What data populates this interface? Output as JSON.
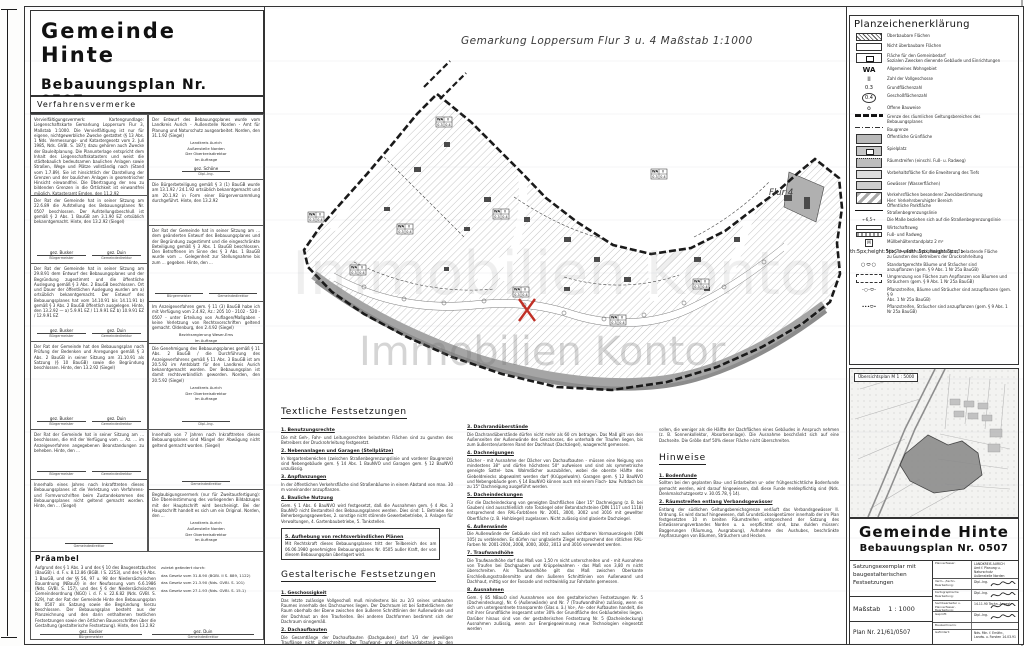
{
  "header": {
    "municipality": "Gemeinde  Hinte",
    "plan_title": "Bebauungsplan  Nr. 0507"
  },
  "map": {
    "title": "Gemarkung  Loppersum    Flur 3 u. 4     Maßstab 1:1000",
    "flur_label": "Flur 4",
    "watermark": "Immobilien Kontor",
    "wa_box": {
      "use": "WA",
      "storeys": "II",
      "grz": "0.3",
      "gfz": "0.4"
    }
  },
  "verfahrensvermerke": {
    "header": "Verfahrensvermerke",
    "left": [
      {
        "text": "Vervielfältigungsvermerk: Kartengrundlage: Liegenschaftskarte Gemarkung Loppersum Flur 3, Maßstab 1:1000. Die Vervielfältigung ist nur für eigene, nichtgewerbliche Zwecke gestattet (§ 13 Abs. 1 Nds. Vermessungs- und Katastergesetz vom 2. Juli 1985, Nds. GVBl. S. 187); dazu gehören auch Zwecke der Bauleitplanung. Die Planunterlage entspricht dem Inhalt des Liegenschaftskatasters und weist die städtebaulich bedeutsamen baulichen Anlagen sowie Straßen, Wege und Plätze vollständig nach (Stand vom 1.7.89). Sie ist hinsichtlich der Darstellung der Grenzen und der baulichen Anlagen in geometrischer Hinsicht einwandfrei. Die Übertragung der neu zu bildenden Grenzen in die Örtlichkeit ist einwandfrei möglich. Katasteramt Emden, den 11.2.92",
        "sigs": [
          {
            "name": "gez. Specht",
            "role": "Oberamtsrat"
          }
        ]
      },
      {
        "text": "Der Rat der Gemeinde hat in seiner Sitzung am 22.6.89 die Aufstellung des Bebauungsplanes Nr. 0507 beschlossen. Der Aufstellungsbeschluß ist gemäß § 2 Abs. 1 BauGB am 3.1.90 EZ ortsüblich bekanntgemacht. Hinte, den 13.2.92 (Siegel)",
        "sigs": [
          {
            "name": "gez. Busker",
            "role": "Bürgermeister"
          },
          {
            "name": "gez. Duin",
            "role": "Gemeindedirektor"
          }
        ]
      },
      {
        "text": "Der Rat der Gemeinde hat in seiner Sitzung am 29.8.91 dem Entwurf des Bebauungsplanes und der Begründung zugestimmt und die öffentliche Auslegung gemäß § 3 Abs. 2 BauGB beschlossen. Ort und Dauer der öffentlichen Auslegung wurden am a) ortsüblich bekanntgemacht. Der Entwurf des Bebauungsplanes hat vom 14.10.91 bis 14.11.91 b) gemäß § 3 Abs. 2 BauGB öffentlich ausgelegen. Hinte, den 13.2.92  —  a) 5.9.91 EZ / 11.9.91 EZ   b) 10.9.91 EZ / 12.9.91 EZ",
        "sigs": [
          {
            "name": "gez. Busker",
            "role": "Bürgermeister"
          },
          {
            "name": "gez. Duin",
            "role": "Gemeindedirektor"
          }
        ]
      },
      {
        "text": "Der Rat der Gemeinde hat den Bebauungsplan nach Prüfung der Bedenken und Anregungen gemäß § 3 Abs. 2 BauGB in seiner Sitzung am 31.10.91 als Satzung (§ 10 BauGB) sowie die Begründung beschlossen. Hinte, den 13.2.92 (Siegel)",
        "sigs": [
          {
            "name": "gez. Busker",
            "role": "Bürgermeister"
          },
          {
            "name": "gez. Duin",
            "role": "Gemeindedirektor"
          }
        ]
      },
      {
        "text": "Der Rat der Gemeinde hat in seiner Sitzung am ... beschlossen, die mit der Verfügung vom ... Az. ... im Anzeigeverfahren angegebenen Beanstandungen zu beheben. Hinte, den ...",
        "sigs": [
          {
            "name": "",
            "role": "Bürgermeister"
          },
          {
            "name": "",
            "role": "Gemeindedirektor"
          }
        ]
      },
      {
        "text": "Innerhalb eines Jahres nach Inkrafttreten dieses Bebauungsplanes ist die Verletzung von Verfahrens- und Formvorschriften beim Zustandekommen des Bebauungsplanes nicht geltend gemacht worden. Hinte, den ... (Siegel)",
        "sigs": [
          {
            "name": "",
            "role": "Gemeindedirektor"
          }
        ]
      }
    ],
    "right": [
      {
        "text": "Der Entwurf des Bebauungsplanes wurde vom Landkreis Aurich - Außenstelle Norden - Amt für Planung und Naturschutz ausgearbeitet. Norden, den 31.1.92 (Siegel)",
        "center": [
          "Landkreis Aurich",
          "Außenstelle Norden",
          "Der Oberkreisdirektor",
          "Im Auftrage"
        ],
        "sigs": [
          {
            "name": "gez. Schöne",
            "role": "Dipl.-Ing."
          }
        ]
      },
      {
        "text": "Die Bürgerbeteiligung gemäß § 3 (1) BauGB wurde am 13.1.92 / 24.1.92 ortsüblich bekanntgemacht und am 20.1.92 in Form einer Bürgerversammlung durchgeführt. Hinte, den 13.2.92"
      },
      {
        "text": "Der Rat der Gemeinde hat in seiner Sitzung am ... dem geänderten Entwurf des Bebauungsplanes und der Begründung zugestimmt und die eingeschränkte Beteiligung gemäß § 3 Abs. 1 BauGB beschlossen. Den Betroffenen im Sinne des § 3 Abs. 1 BauGB wurde vom ... Gelegenheit zur Stellungnahme bis zum ... gegeben. Hinte, den ...",
        "sigs": [
          {
            "name": "",
            "role": "Bürgermeister"
          },
          {
            "name": "",
            "role": "Gemeindedirektor"
          }
        ]
      },
      {
        "text": "Im Anzeigeverfahren gem. § 11 (3) BauGB habe ich mit Verfügung vom 2.4.92, Az.: 205 10 - 2102 - 520 - 0507 - unter Erteilung von Auflagen/Maßgaben - keine Verletzung von Rechtsvorschriften geltend gemacht. Oldenburg, den 2.4.92 (Siegel)",
        "center": [
          "Bezirksregierung Weser-Ems",
          "Im Auftrage"
        ],
        "sigs": [
          {
            "name": "gez. Dr. Müller",
            "role": ""
          }
        ]
      },
      {
        "text": "Die Genehmigung des Bebauungsplanes gemäß § 11 Abs. 2 BauGB / die Durchführung des Anzeigeverfahrens gemäß § 11 Abs. 3 BauGB ist am 20.5.92 im Amtsblatt für den Landkreis Aurich bekanntgemacht worden. Der Bebauungsplan ist damit rechtsverbindlich geworden. Norden, den 20.5.92 (Siegel)",
        "center": [
          "Landkreis Aurich",
          "Der Oberkreisdirektor",
          "Im Auftrage"
        ],
        "sigs": [
          {
            "name": "",
            "role": "Dipl.-Ing."
          }
        ]
      },
      {
        "text": "Innerhalb von 7 Jahren nach Inkrafttreten dieses Bebauungsplanes sind Mängel der Abwägung nicht geltend gemacht worden. (Siegel)",
        "sigs": [
          {
            "name": "",
            "role": "Gemeindedirektor"
          }
        ]
      },
      {
        "text": "Beglaubigungsvermerk (nur für Zweitausfertigung): Die Übereinstimmung des vorliegenden Bildabzuges mit der Hauptschrift wird bescheinigt. Bei der Hauptschrift handelt es sich um ein Original. Norden, den ...",
        "center": [
          "Landkreis Aurich",
          "Außenstelle Norden",
          "Der Oberkreisdirektor",
          "Im Auftrage"
        ]
      }
    ],
    "praeambel": {
      "header": "Präambel",
      "text": "Aufgrund des § 1 Abs. 3 und des § 10 des Baugesetzbuches (BauGB) i. d. F. v. 8.12.86 (BGBl. I S. 2253), und des § 9 Abs. 1 BauGB, und der §§ 56, 97 u. 98 der Niedersächsischen Bauordnung (NBauO) in der Neufassung vom 6.6.1986 (Nds. GVBl. S. 157), und des § 6 der Niedersächsischen Gemeindeordnung (NGO) i. d. F. v. 22.6.82 (Nds. GVBl. S. 229), hat der Rat der Gemeinde Hinte den Bebauungsplan Nr. 0507 als Satzung sowie die Begründung hierzu beschlossen. Der Bebauungsplan besteht aus der Planzeichnung und den darin enthaltenen textlichen Festsetzungen sowie den örtlichen Bauvorschriften über die Gestaltung (gestalterische Festsetzung). Hinte, den 13.2.92",
      "amend_label": "zuletzt geändert durch:",
      "amendments": [
        "das Gesetz vom 31.8.90 (BGBl. II S. 889, 1122)",
        "das Gesetz vom 21.3.90 (Nds. GVBl. S. 101)",
        "das Gesetz vom 27.1.93 (Nds. GVBl. S. 15.1)"
      ],
      "sigs": [
        {
          "name": "gez. Busker",
          "role": "Bürgermeister"
        },
        {
          "name": "gez. Duin",
          "role": "Gemeindedirektor"
        }
      ]
    }
  },
  "legend": {
    "header": "Planzeichenerklärung",
    "symbols": {
      "wa": "WA",
      "ii": "II",
      "grz": "0.3",
      "gfz": "0.4",
      "o": "o",
      "muell": "M",
      "masse": "6,5"
    },
    "items": [
      {
        "sym": "hatch",
        "label": "Überbaubare Flächen"
      },
      {
        "sym": "openbox",
        "label": "Nicht überbaubare Flächen"
      },
      {
        "sym": "gemeinbedarf",
        "label": [
          "Fläche für den Gemeinbedarf",
          "Sozialen Zwecken dienende Gebäude und Einrichtungen"
        ]
      },
      {
        "sym": "wa",
        "label": "Allgemeines Wohngebiet"
      },
      {
        "sym": "ii",
        "label": "Zahl der Vollgeschosse"
      },
      {
        "sym": "grz",
        "label": "Grundflächenzahl"
      },
      {
        "sym": "gfz",
        "label": "Geschoßflächenzahl"
      },
      {
        "sym": "o",
        "label": "Offene Bauweise"
      },
      {
        "sym": "grenze",
        "label": "Grenze des räumlichen Geltungsbereiches des Bebauungsplanes"
      },
      {
        "sym": "baugrenze",
        "label": "Baugrenze"
      },
      {
        "sym": "gruen",
        "label": "Öffentliche Grünfläche"
      },
      {
        "sym": "spiel",
        "label": "Spielplatz"
      },
      {
        "sym": "raum",
        "label": "Räumstreifen (einschl. Fuß- u. Radweg)"
      },
      {
        "sym": "vorbehalt",
        "label": "Vorbehaltsfläche für die Erweiterung des Tiefs"
      },
      {
        "sym": "wasser",
        "label": "Gewässer (Wasserflächen)"
      },
      {
        "sym": "verkehr",
        "label": [
          "Verkehrsflächen besonderer Zweckbestimmung",
          "Hier: Verkehrsberuhigter Bereich",
          "Öffentliche Parkfläche"
        ]
      },
      {
        "sym": "strasse",
        "label": "Straßenbegrenzungslinie"
      },
      {
        "sym": "masse",
        "label": "Die Maße beziehen sich auf die Straßenbegrenzungslinie"
      },
      {
        "sym": "wweg",
        "label": "Wirtschaftsweg"
      },
      {
        "sym": "radweg",
        "label": "Fuß- und Radweg"
      },
      {
        "sym": "muell",
        "label": "Müllbehälterstandplatz  2 m²"
      },
      {
        "sym": "leitung",
        "label": [
          "Mit Geh-, Fahr- und Leitungsrecht zu belastende Fläche",
          "zu Gunsten des Betreibers der Druckrohrleitung"
        ]
      },
      {
        "sym": "baeume",
        "label": [
          "Standortgerechte Bäume und Sträucher sind",
          "anzupflanzen (gem. § 9 Abs. 1 Nr 25a BauGB)"
        ]
      },
      {
        "sym": "umgrenzung",
        "label": [
          "Umgrenzung von Flächen zum Anpflanzen von Bäumen und",
          "Sträuchern (gem. § 9 Abs. 1 Nr 25a BauGB)"
        ]
      },
      {
        "sym": "pflanz1",
        "label": [
          "Pflanzstreifen, Bäume und Sträucher sind anzupflanzen (gem. § 9",
          "Abs. 1 Nr 25a BauGB)"
        ]
      },
      {
        "sym": "pflanz2",
        "label": [
          "Pflanzstreifen, Sträucher sind anzupflanzen (gem. § 9 Abs. 1",
          "Nr 25a BauGB)"
        ]
      }
    ]
  },
  "overview": {
    "label": "Übersichtsplan  M 1 : 5000"
  },
  "title_block": {
    "municipality": "Gemeinde  Hinte",
    "plan_title": "Bebauungsplan  Nr. 0507",
    "exemplar": "Satzungsexemplar mit baugestalterischen Festsetzungen",
    "scale_label": "Maßstab",
    "scale_value": "1 : 1000",
    "plan_no": "Plan  Nr.  21/61/0507",
    "rows": [
      {
        "label": "Planverfasser:",
        "lines": [
          "LANDKREIS AURICH",
          "Amt f. Planung u. Naturschutz",
          "Außenstelle Norden"
        ]
      },
      {
        "label": "Verm.- /techn. Bearbeitung:",
        "lines": [
          "Dipl.-Ing."
        ],
        "signed": true
      },
      {
        "label": "Kartographische Bearbeitung:",
        "lines": [
          "Dipl.-Ing."
        ],
        "signed": true
      },
      {
        "label": "Sachbearbeiter u. Planverfasser, Bearbeitung:",
        "lines": [
          "14.11.90  Techn.-Angest."
        ],
        "signed": true
      },
      {
        "label": "Geprüft:",
        "lines": [
          "Dipl.-Ing."
        ],
        "signed": true
      },
      {
        "label": "Bauzeichnerin:",
        "lines": [
          ""
        ]
      },
      {
        "label": "Gefördert:",
        "lines": [
          "Nds. Min. f. Ernähr.,",
          "Landw. u. Forsten  14.03.91"
        ]
      }
    ]
  },
  "festsetzungen": {
    "textliche": {
      "header": "Textliche Festsetzungen",
      "items": [
        {
          "h": "1. Benutzungsrechte",
          "b": "Die mit Geh-, Fahr- und Leitungsrechten belasteten Flächen sind zu gunsten des Betreibers der Druckrohrleitung festgesetzt."
        },
        {
          "h": "2. Nebenanlagen und Garagen (Stellplätze)",
          "b": "In Vorgartenbereichen (zwischen Straßenbegrenzungslinie und vorderer Baugrenze) sind Nebengebäude gem. § 14 Abs. 1 BauNVO und Garagen gem. § 12 BauNVO unzulässig."
        },
        {
          "h": "3. Anpflanzungen",
          "b": "In der öffentlichen Verkehrsfläche sind Straßenbäume in einem Abstand von max. 30 m voneinander anzupflanzen."
        },
        {
          "h": "4. Bauliche Nutzung",
          "b": "Gem. § 1 Abs. 6 BauNVO wird festgesetzt, daß die Ausnahmen gem. § 4 Abs. 3 BauNVO nicht Bestandteil des Bebauungsplanes werden. Dies sind: 1. Betriebe des Beherbergungsgewerbes, 2. sonstige nicht störende Gewerbebetriebe, 3. Anlagen für Verwaltungen, 4. Gartenbaubetriebe, 5. Tankstellen."
        }
      ],
      "boxed": {
        "h": "5. Aufhebung von rechtsverbindlichen Plänen",
        "b": "Mit Rechtskraft dieses Bebauungsplanes tritt der Teilbereich des am 06.06.1980 genehmigten Bebauungsplanes Nr. 0505 außer Kraft, der von diesem Bebauungsplan überlagert wird."
      }
    },
    "gestalterische": {
      "header": "Gestalterische Festsetzungen",
      "col1_items": [
        {
          "h": "1. Geschossigkeit",
          "b": "Das letzte zulässige Vollgeschoß muß mindestens bis zu 2/3 seines umbauten Raumes innerhalb des Dachraumes liegen. Der Dachraum ist bei Satteldächern der Raum oberhalb der Ebene zwischen den äußeren Schnittlinien der Außenwände und der Dachhaut an den Traufseiten. Bei anderen Dachformen bestimmt sich der Dachraum sinngemäß."
        },
        {
          "h": "2. Dachaufbauten",
          "b": "Die Gesamtlänge der Dachaufbauten (Dachgauben) darf 1/3 der jeweiligen Trauflänge nicht überschreiten. Der Traufwand- und Giebelwandabstand zu den Dachaufbauten (Außenseite der Außenwände) und der Abstand des Dachaustritts zum First - im Walmgrat in Dachneigung gemessen - darf das Maß von 1,0 m an keiner Stelle unterschreiten."
        }
      ],
      "col2_items": [
        {
          "h": "3. Dachrandüberstände",
          "b": "Die Dachrandüberstände dürfen nicht mehr als 60 cm betragen. Das Maß gilt von den Außenseiten der Außenwände des Geschosses, die unterhalb der Traufen liegen, bis zum äußersten/unteren Rand der Dachhaut (Dachziegel), waagerecht gemessen."
        },
        {
          "h": "4. Dachneigungen",
          "b": "Dächer - mit Ausnahme der Dächer von Dachaufbauten - müssen eine Neigung von mindestens 38° und dürfen höchstens 50° aufweisen und sind als symmetrische geneigte Sattel- bzw. Walmdächer auszubilden, wobei die oberste Hälfte des Giebeldreiecks abgewalmt werden darf (Krüppelwalm). Garagen gem. § 12 BauNVO und Nebengebäude gem. § 14 BauNVO können auch mit einem Flach- bzw. Pultdach bis zu 15° Dachneigung ausgeführt werden."
        },
        {
          "h": "5. Dacheindeckungen",
          "b": "Für die Dacheindeckung von geneigten Dachflächen über 15° Dachneigung (z. B. bei Gauben) sind ausschließlich rote Tonziegel oder Betondachsteine (DIN 1117 und 1118) entsprechend den RAL-Farbtönen Nr. 2001, 3000, 3002 und 3016 mit gewellter Oberfläche (z. B. Hohlziegel) zugelassen. Nicht zulässig sind glasierte Dachziegel."
        },
        {
          "h": "6. Außenwände",
          "b": "Die Außenwände der Gebäude sind mit nach außen sichtbaren Vormauerziegeln (DIN 105) zu verblenden. Es dürfen nur unglasierte Ziegel entsprechend den rötlichen RAL-Farben Nr. 2001-2004, 2008, 3000, 3002, 3013 und 3016 verwendet werden."
        },
        {
          "h": "7. Traufwandhöhe",
          "b": "Die Traufwandhöhe darf das Maß von 1,50 m nicht unterschreiten und - mit Ausnahme von Traufen bei Dachgauben und Krüppelwalmen - das Maß von 3,80 m nicht überschreiten. Als Traufwandhöhe gilt das Maß zwischen Oberkante Erschließungsstraßenmitte und den äußeren Schnittlinien von Außenwand und Dachhaut, mittig vor der Fassade und rechtwinklig zur Fahrbahn gemessen."
        },
        {
          "h": "8. Ausnahmen",
          "b": "Gem. § 85 NBauO sind Ausnahmen von den gestalterischen Festsetzungen Nr. 5 (Dacheindeckung), Nr. 6 (Außenwände) und Nr. 7 (Traufwandhöhe) zulässig, wenn es sich um untergeordnete transparente (Glas o. ä.) Vor-, An- oder Aufbauten handelt, die mit ihrer Grundfläche insgesamt unter 30% der Grundfläche des Gebäudeteiles liegen. Darüber hinaus sind von der gestalterischen Festsetzung Nr. 5 (Dacheindeckung) Ausnahmen zulässig, wenn zur Energiegewinnung neue Technologien eingesetzt werden"
        }
      ]
    },
    "hinweise": {
      "continuation": "sollen, die weniger als die Hälfte der Dachflächen eines Gebäudes in Anspruch nehmen (z. B. Sonnenkollektor, Absorberanlage). Die Ausnahme beschränkt sich auf eine Dachseite. Die Größe darf 50% dieser Fläche nicht überschreiten.",
      "header": "Hinweise",
      "items": [
        {
          "h": "1. Bodenfunde",
          "b": "Sollten bei den geplanten Bau- und Erdarbeiten ur- oder frühgeschichtliche Bodenfunde gemacht werden, wird darauf hingewiesen, daß diese Funde meldepflichtig sind (Nds. Denkmalschutzgesetz v. 30.05.78, § 14)."
        },
        {
          "h": "2. Räumstreifen entlang Verbandsgewässer",
          "b": "Entlang der südlichen Geltungsbereichsgrenze verläuft das Verbandsgewässer II. Ordnung. Es wird darauf hingewiesen, daß Grundstückseigentümer innerhalb der im Plan festgesetzten 10 m breiten Räumstreifen entsprechend der Satzung des Entwässerungsverbandes Norden u. a. verpflichtet sind, bzw. dulden müssen: Baggerungen (Räumung, Ausgrabung), Aufnahme des Aushubes, beschränkte Anpflanzungen von Bäumen, Sträuchern und Hecken."
        }
      ]
    }
  }
}
